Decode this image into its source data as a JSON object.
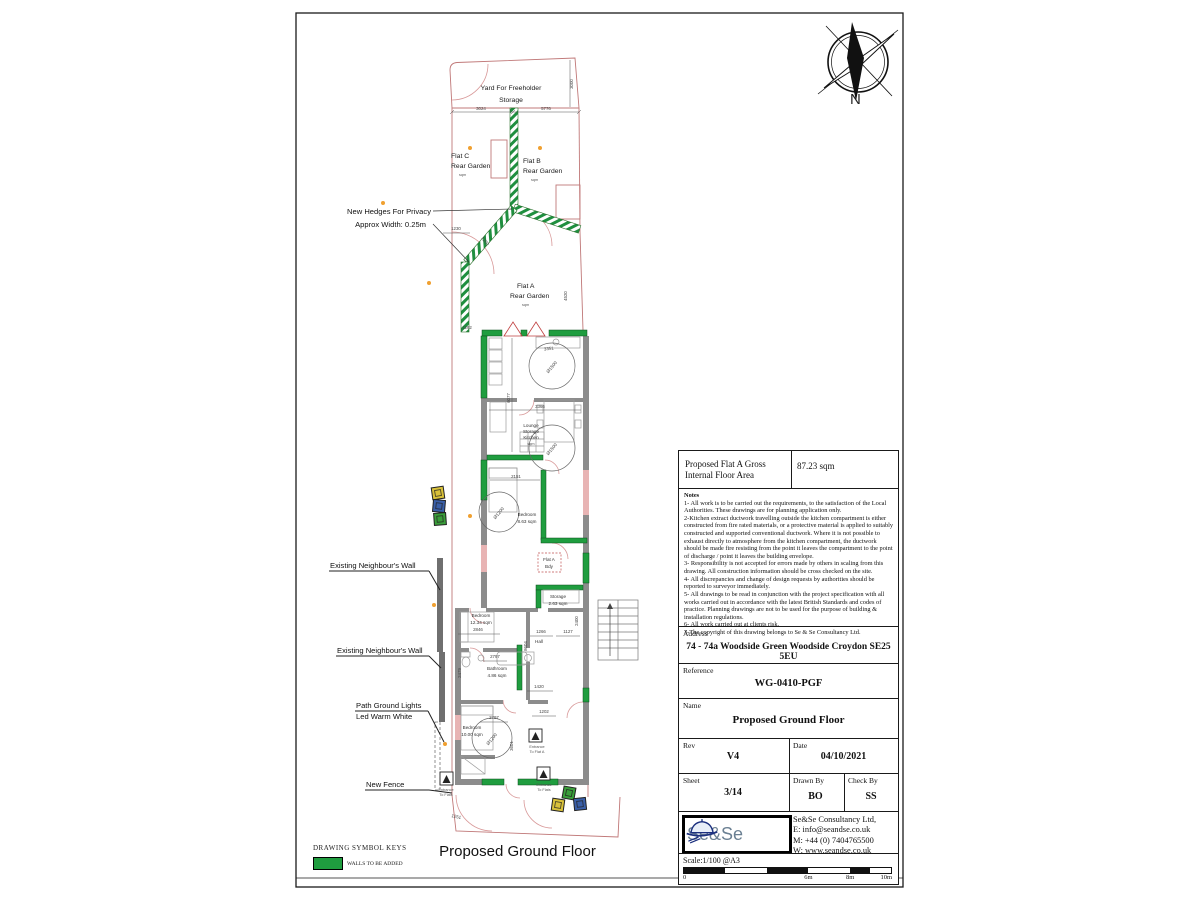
{
  "sheet_title": "Proposed Ground Floor",
  "legend": {
    "title": "DRAWING SYMBOL KEYS",
    "wall_key": "WALLS TO BE ADDED"
  },
  "colors": {
    "wall_new": "#1f9d3f",
    "wall_existing": "#8c8c8c",
    "boundary": "#c07878",
    "window": "#e8b4b4",
    "logo_blue": "#1b2f7e",
    "logo_text": "#6b8093",
    "bin_yellow": "#d9c13a",
    "bin_blue": "#3a5fa8",
    "bin_green": "#3a9e3a",
    "light_dot": "#f0a030"
  },
  "plan": {
    "north_label": "N",
    "yard_label": [
      "Yard For Freeholder",
      "Storage"
    ],
    "flat_c_garden": [
      "Flat C",
      "Rear Garden",
      "sqm"
    ],
    "flat_b_garden": [
      "Flat B",
      "Rear Garden",
      "sqm"
    ],
    "flat_a_garden": [
      "Flat A",
      "Rear Garden",
      "sqm"
    ],
    "hedge_note": [
      "New Hedges For Privacy",
      "Approx Width: 0.25m"
    ],
    "annotations": [
      "Existing Neighbour's Wall",
      "Existing Neighbour's Wall",
      "Path Ground Lights",
      "Led Warm White",
      "New Fence"
    ],
    "rooms": {
      "lounge": [
        "Lounge",
        "Storage",
        "Kitchen",
        "sqm"
      ],
      "bedroom1": [
        "Bedroom",
        "8.63 sqm"
      ],
      "flat_a_bdy": [
        "Flat A",
        "Bdy"
      ],
      "storage": [
        "Storage",
        "2.63 sqm"
      ],
      "bedroom2": [
        "Bedroom",
        "12.34 sqm"
      ],
      "hall": "Hall",
      "bathroom": [
        "Bathroom",
        "4.86 sqm"
      ],
      "bedroom3": [
        "Bedroom",
        "10.00 sqm"
      ]
    },
    "entrances": {
      "flat_a": [
        "Entrance",
        "To Flat A"
      ],
      "flats1": [
        "Entrance",
        "To Flats"
      ],
      "flats2": [
        "Entrance",
        "To Flats"
      ]
    },
    "circles": {
      "c1500": "Ø1500",
      "c1200": "Ø1200"
    },
    "dims": {
      "d3024": "3024",
      "d5776": "5776",
      "d3000": "3000",
      "d1230": "1230",
      "d1260": "1260",
      "d1292": "1292",
      "d4520": "4520",
      "d3351": "3351",
      "d6077": "6077",
      "d3366": "3366",
      "d2151": "2151",
      "d2846": "2846",
      "d1266": "1266",
      "d1127": "1127",
      "d2400": "2400",
      "d8604": "8604",
      "d2797a": "2797",
      "d2479": "2479",
      "d1420": "1420",
      "d1202": "1202",
      "d2797b": "2797",
      "d3601": "3601",
      "d1251": "1251"
    }
  },
  "titleblock": {
    "area_row": {
      "label": "Proposed Flat A Gross Internal Floor Area",
      "value": "87.23 sqm"
    },
    "notes_title": "Notes",
    "notes": [
      "1- All work is to be carried out the requirements, to the satisfaction of the Local Authorities. These drawings are for planning application only.",
      "2-Kitchen extract ductwork travelling outside the kitchen compartment is either constructed from fire rated materials, or a protective material is applied to suitably constructed and supported conventional ductwork. Where it is not possible to exhaust directly to atmosphere from the kitchen compartment, the ductwork should be made fire resisting from the point it leaves the compartment to the point of discharge / point it leaves the building envelope.",
      "3- Responsibility is not accepted for errors made by others in scaling from this drawing. All construction information should be cross checked on the site.",
      "4- All discrepancies and change of design requests by authorities should be reported to surveyor immediately.",
      "5- All drawings to be read in conjunction with the project specification with all works carried out in accordance with the latest British Standards and codes of practice. Planning drawings are not to be used for the purpose of building & installation regulations.",
      "6- All work carried out at clients risk.",
      "7-The copyright of this drawing belongs to Se & Se Consultancy Ltd."
    ],
    "address_label": "Address",
    "address": "74 - 74a Woodside Green Woodside Croydon SE25 5EU",
    "reference_label": "Reference",
    "reference": "WG-0410-PGF",
    "name_label": "Name",
    "name": "Proposed Ground Floor",
    "rev_label": "Rev",
    "rev": "V4",
    "date_label": "Date",
    "date": "04/10/2021",
    "sheet_label": "Sheet",
    "sheet": "3/14",
    "drawn_label": "Drawn By",
    "drawn": "BO",
    "check_label": "Check By",
    "check": "SS",
    "logo_text": "Se&Se",
    "company": [
      "Se&Se Consultancy Ltd,",
      "E: info@seandse.co.uk",
      "M: +44 (0) 7404765500",
      "W: www.seandse.co.uk"
    ],
    "scale_label": "Scale:1/100 @A3",
    "scale_ticks": [
      "0",
      "6m",
      "8m",
      "10m"
    ]
  }
}
